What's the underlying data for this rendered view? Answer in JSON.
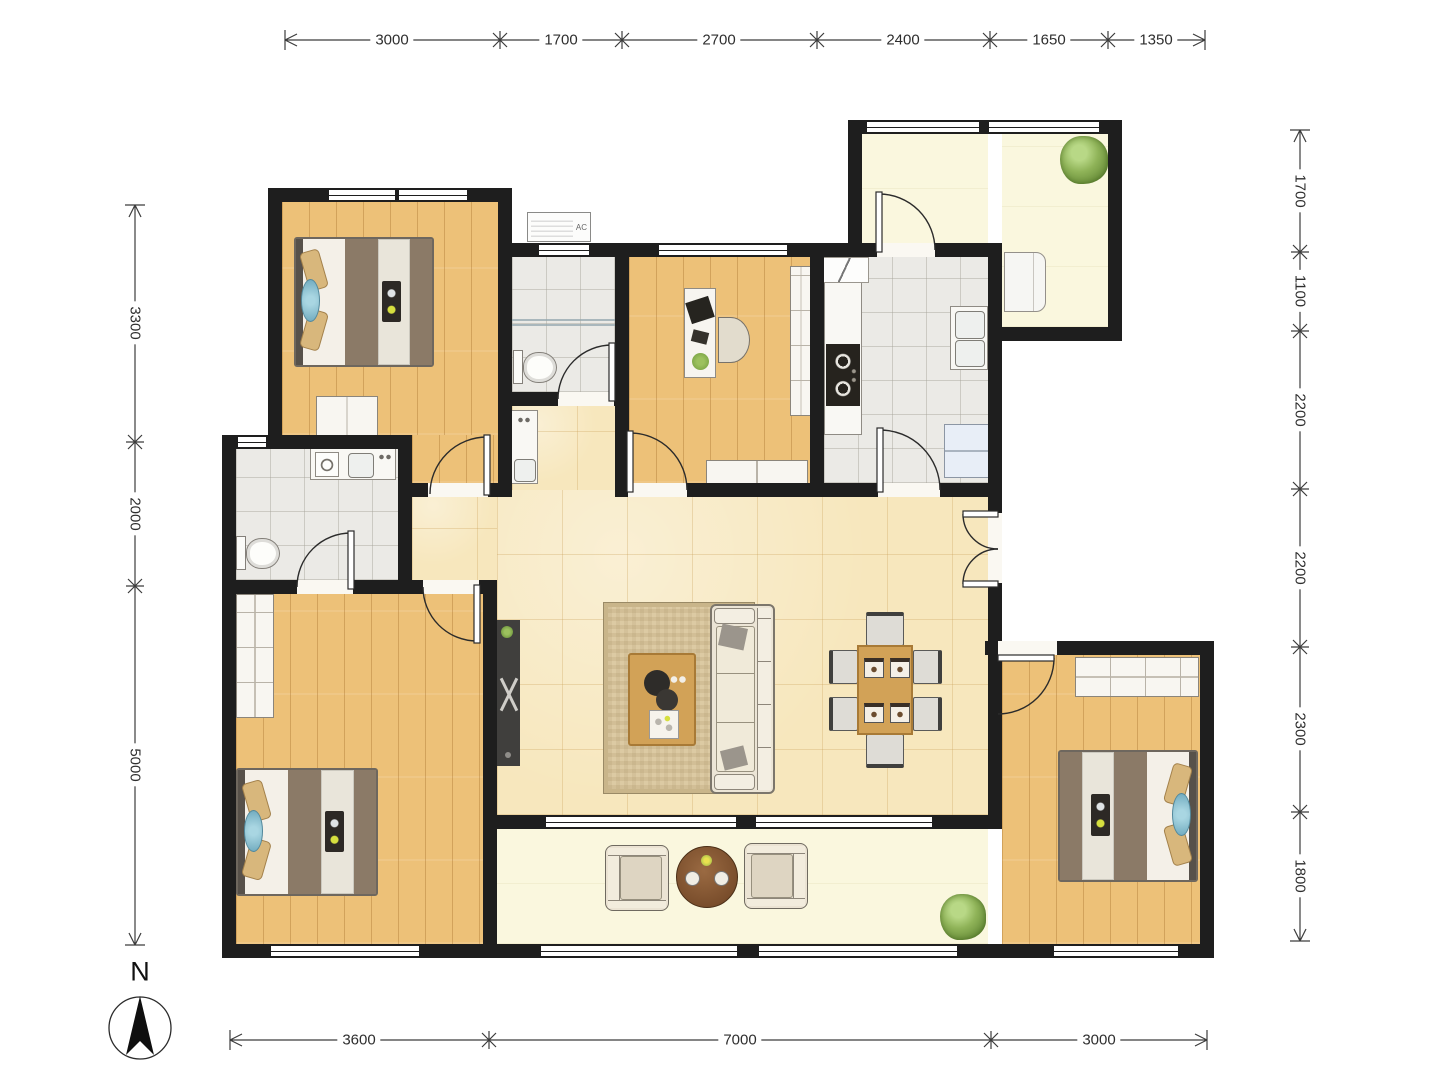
{
  "title": "apartment-floor-plan",
  "labels": {
    "compass_north": "N",
    "ac_unit": "AC"
  },
  "dimensions": {
    "unit": "mm",
    "top": [
      "3000",
      "1700",
      "2700",
      "2400",
      "1650",
      "1350"
    ],
    "bottom": [
      "3600",
      "7000",
      "3000"
    ],
    "left": [
      "3300",
      "2000",
      "5000"
    ],
    "right": [
      "1700",
      "1100",
      "2200",
      "2200",
      "2300",
      "1800"
    ]
  },
  "colors": {
    "wall": "#1e1e1e",
    "wood_floor": "#edc178",
    "living_tile": "#f7e7bd",
    "bath_tile": "#ebeae6",
    "balcony_floor": "#faf7de",
    "furniture_wood": "#d2a257",
    "fabric": "#ece5d6",
    "blanket": "#8b7a67",
    "pillow": "#d8b77c",
    "blue_cushion": "#6ea9bd",
    "plant": "#678c38"
  }
}
